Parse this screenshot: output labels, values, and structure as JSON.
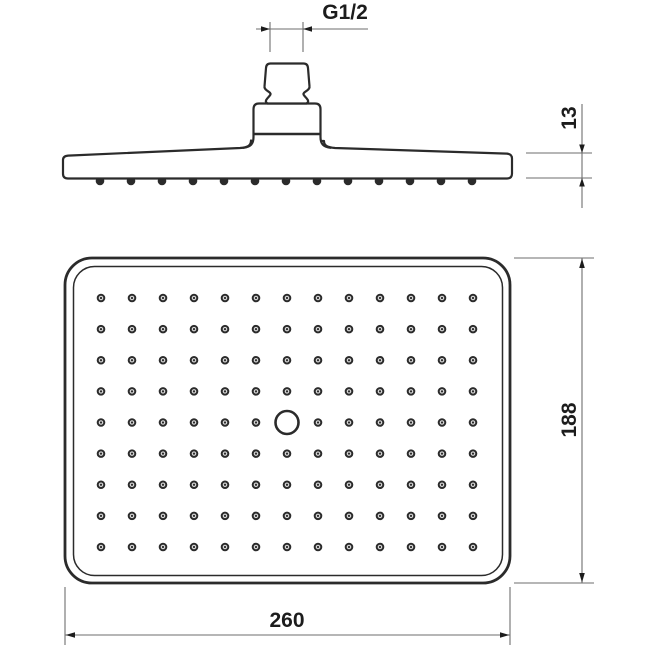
{
  "meta": {
    "title": "Overhead shower head technical drawing, side view and spray face view"
  },
  "colors": {
    "background": "#ffffff",
    "outline": "#2b2b2b",
    "dim_line": "#6e6e6e",
    "dim_text": "#1c1c1c",
    "nozzle_fill": "#d9d9d9"
  },
  "side_view": {
    "label": "side-view",
    "thread_dim_label": "G1/2",
    "thickness_dim_label": "13",
    "nozzle_tips": {
      "count": 13,
      "x0": 100,
      "dx": 31,
      "y": 181,
      "r": 4.3
    }
  },
  "face_view": {
    "label": "face-view",
    "height_dim_label": "188",
    "width_dim_label": "260",
    "nozzle_grid": {
      "cols": 13,
      "rows": 9,
      "x0": 101,
      "y0": 298,
      "dx": 31,
      "dy": 31.125,
      "center_hole_col": 7,
      "center_hole_row": 5
    }
  }
}
